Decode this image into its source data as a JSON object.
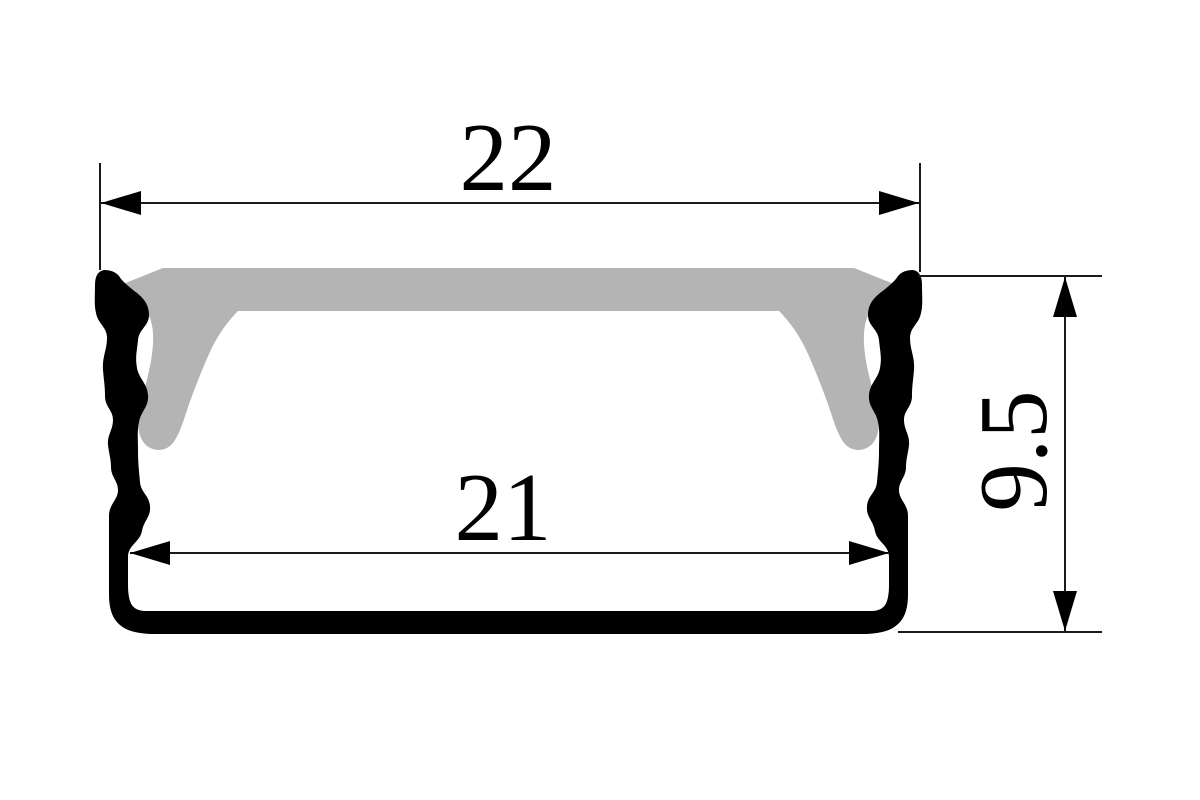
{
  "drawing": {
    "dimensions": {
      "top_width": "22",
      "inner_width": "21",
      "height": "9.5"
    },
    "colors": {
      "profile": "#000000",
      "diffuser": "#b4b4b4",
      "lines": "#1a1a1a",
      "background": "#ffffff"
    }
  }
}
